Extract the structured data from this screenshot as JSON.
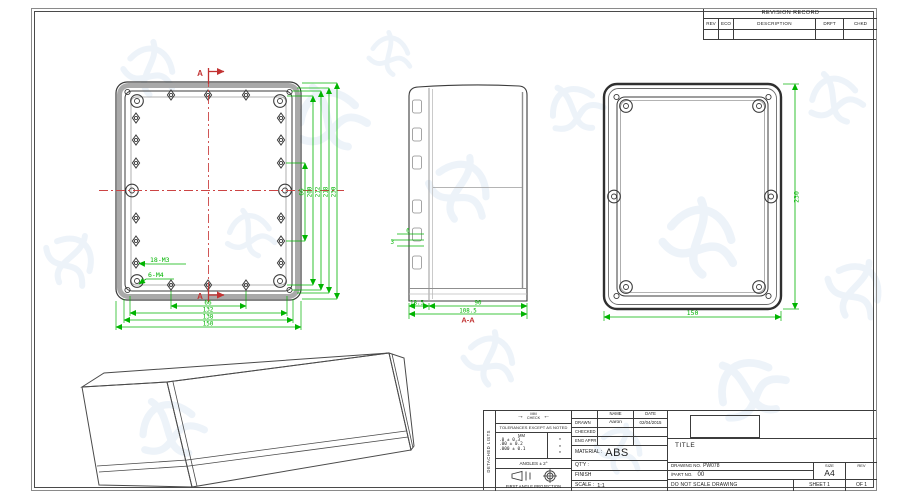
{
  "colors": {
    "dim_green": "#00b400",
    "mark_red": "#c23232",
    "centerline_red": "#cc4444",
    "line_dark": "#3b3b3b",
    "line_gray": "#9b9b9b",
    "watermark_blue": "#c3d6ec"
  },
  "revision_table": {
    "title": "REVISION RECORD",
    "columns": [
      "REV",
      "ECO",
      "DESCRIPTION",
      "DRFT",
      "CHKD"
    ]
  },
  "plan_view": {
    "section_label_top": "A",
    "section_label_bottom": "A",
    "callout_bosses": "18-M3",
    "callout_ears": "6-M4",
    "dims_bottom": [
      "66",
      "132",
      "138",
      "150"
    ],
    "dims_right": [
      "66",
      "200",
      "212",
      "218",
      "230"
    ]
  },
  "section_view": {
    "label": "A-A",
    "dim_lid": "18.5",
    "dim_body": "90",
    "dim_total": "108.5",
    "dim_rib": "3",
    "dim_boss": "6"
  },
  "back_view": {
    "dim_height": "230",
    "dim_width": "150"
  },
  "title_block": {
    "side_note": "DETACHED LISTS",
    "icons": {
      "arrow_right": "→",
      "arrow_left": "←"
    },
    "units_label": "MM",
    "check_label": "CHECK",
    "tol_note": "TOLERANCES EXCEPT AS NOTED",
    "tol_unit_header": "MM",
    "tol_rows": [
      ".0    ± 0.3",
      ".00   ± 0.2",
      ".000 ± 0.1"
    ],
    "tol_marks": [
      "*",
      "*",
      "*"
    ],
    "angles_note": "ANGLES ± 2°",
    "projection_note": "FIRST ANGLE PROJECTION",
    "name_header": "NAME",
    "date_header": "DATE",
    "drawn_label": "DRAWN",
    "drawn_name": "Aaron",
    "drawn_date": "02/04/2015",
    "checked_label": "CHECKED",
    "eng_appr_label": "ENG APPR",
    "material_label": "MATERIAL :",
    "material_value": "ABS",
    "qty_label": "QT'Y :",
    "finish_label": "FINISH",
    "scale_label": "SCALE :",
    "scale_value": "1:1",
    "title_label": "TITLE",
    "drawing_no_label": "DRAWING NO.",
    "drawing_no_value": "PW078",
    "part_no_label": "/PART  NO.",
    "part_no_value": "00",
    "size_label": "SIZE",
    "size_value": "A4",
    "rev_label": "REV",
    "no_scale_note": "DO NOT SCALE DRAWING",
    "sheet_label": "SHEET 1",
    "of_label": "OF 1"
  }
}
